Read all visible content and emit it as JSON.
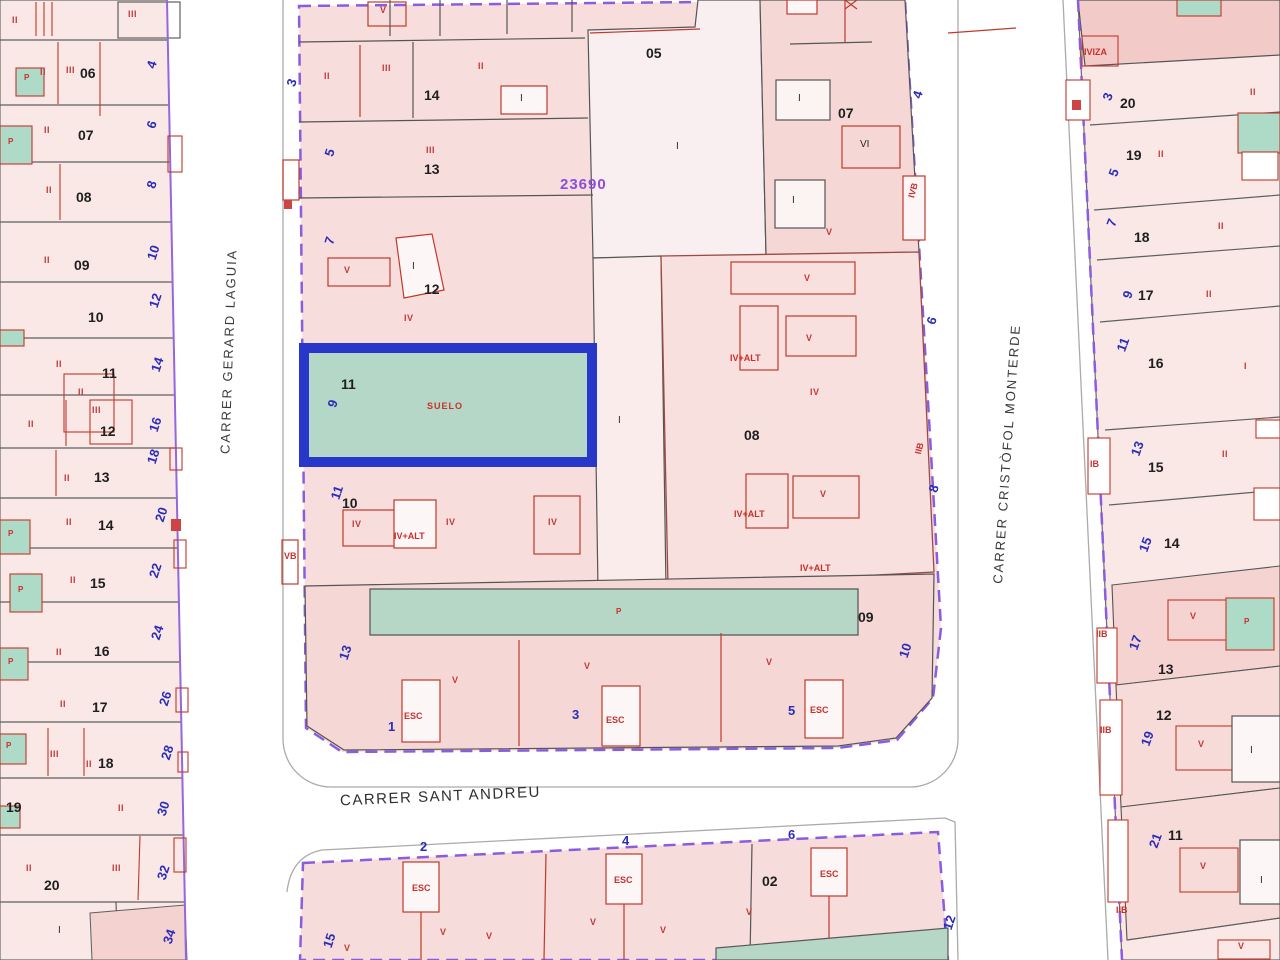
{
  "map": {
    "reference_number": "23690",
    "streets": {
      "left": "CARRER GERARD LAGUIA",
      "right": "CARRER CRISTÒFOL MONTERDE",
      "bottom": "CARRER SANT ANDREU"
    },
    "selected_parcel": {
      "number": "11",
      "street_number": "9",
      "land_label": "SUELO",
      "fill": "#b5d7c8",
      "outline": "#2637c9"
    },
    "colors": {
      "parcel_pink": "#f9e8e6",
      "parcel_pink_dark": "#f2cbc9",
      "teal_green": "#b5d7c8",
      "selection_blue": "#2637c9",
      "boundary_purple": "#8a5ce0",
      "street_number_blue": "#2c2cb8",
      "label_red": "#c9302c",
      "reference_purple": "#8a4fd8"
    },
    "labels": [
      {
        "t": "06",
        "x": 80,
        "y": 66,
        "c": "pn"
      },
      {
        "t": "07",
        "x": 78,
        "y": 128,
        "c": "pn"
      },
      {
        "t": "08",
        "x": 76,
        "y": 190,
        "c": "pn"
      },
      {
        "t": "09",
        "x": 74,
        "y": 258,
        "c": "pn"
      },
      {
        "t": "10",
        "x": 88,
        "y": 310,
        "c": "pn"
      },
      {
        "t": "11",
        "x": 102,
        "y": 366,
        "c": "pn"
      },
      {
        "t": "12",
        "x": 100,
        "y": 424,
        "c": "pn"
      },
      {
        "t": "13",
        "x": 94,
        "y": 470,
        "c": "pn"
      },
      {
        "t": "14",
        "x": 98,
        "y": 518,
        "c": "pn"
      },
      {
        "t": "15",
        "x": 90,
        "y": 576,
        "c": "pn"
      },
      {
        "t": "16",
        "x": 94,
        "y": 644,
        "c": "pn"
      },
      {
        "t": "17",
        "x": 92,
        "y": 700,
        "c": "pn"
      },
      {
        "t": "18",
        "x": 98,
        "y": 756,
        "c": "pn"
      },
      {
        "t": "19",
        "x": 6,
        "y": 800,
        "c": "pn"
      },
      {
        "t": "20",
        "x": 44,
        "y": 878,
        "c": "pn"
      },
      {
        "t": "4",
        "x": 148,
        "y": 58,
        "c": "sn",
        "r": -72
      },
      {
        "t": "6",
        "x": 148,
        "y": 118,
        "c": "sn",
        "r": -72
      },
      {
        "t": "8",
        "x": 148,
        "y": 178,
        "c": "sn",
        "r": -72
      },
      {
        "t": "10",
        "x": 146,
        "y": 246,
        "c": "sn",
        "r": -72
      },
      {
        "t": "12",
        "x": 148,
        "y": 294,
        "c": "sn",
        "r": -72
      },
      {
        "t": "14",
        "x": 150,
        "y": 358,
        "c": "sn",
        "r": -72
      },
      {
        "t": "16",
        "x": 148,
        "y": 418,
        "c": "sn",
        "r": -72
      },
      {
        "t": "18",
        "x": 146,
        "y": 450,
        "c": "sn",
        "r": -72
      },
      {
        "t": "20",
        "x": 154,
        "y": 508,
        "c": "sn",
        "r": -72
      },
      {
        "t": "22",
        "x": 148,
        "y": 564,
        "c": "sn",
        "r": -72
      },
      {
        "t": "24",
        "x": 150,
        "y": 626,
        "c": "sn",
        "r": -72
      },
      {
        "t": "26",
        "x": 158,
        "y": 692,
        "c": "sn",
        "r": -72
      },
      {
        "t": "28",
        "x": 160,
        "y": 746,
        "c": "sn",
        "r": -72
      },
      {
        "t": "30",
        "x": 156,
        "y": 802,
        "c": "sn",
        "r": -72
      },
      {
        "t": "32",
        "x": 156,
        "y": 866,
        "c": "sn",
        "r": -72
      },
      {
        "t": "34",
        "x": 162,
        "y": 930,
        "c": "sn",
        "r": -72
      },
      {
        "t": "II",
        "x": 12,
        "y": 16,
        "c": "rm"
      },
      {
        "t": "III",
        "x": 128,
        "y": 10,
        "c": "rm"
      },
      {
        "t": "II",
        "x": 40,
        "y": 68,
        "c": "rm"
      },
      {
        "t": "III",
        "x": 66,
        "y": 66,
        "c": "rm"
      },
      {
        "t": "II",
        "x": 44,
        "y": 126,
        "c": "rm"
      },
      {
        "t": "II",
        "x": 46,
        "y": 186,
        "c": "rm"
      },
      {
        "t": "II",
        "x": 44,
        "y": 256,
        "c": "rm"
      },
      {
        "t": "II",
        "x": 56,
        "y": 360,
        "c": "rm"
      },
      {
        "t": "II",
        "x": 78,
        "y": 388,
        "c": "rm"
      },
      {
        "t": "III",
        "x": 92,
        "y": 406,
        "c": "rm"
      },
      {
        "t": "II",
        "x": 28,
        "y": 420,
        "c": "rm"
      },
      {
        "t": "II",
        "x": 64,
        "y": 474,
        "c": "rm"
      },
      {
        "t": "II",
        "x": 66,
        "y": 518,
        "c": "rm"
      },
      {
        "t": "II",
        "x": 70,
        "y": 576,
        "c": "rm"
      },
      {
        "t": "II",
        "x": 56,
        "y": 648,
        "c": "rm"
      },
      {
        "t": "II",
        "x": 60,
        "y": 700,
        "c": "rm"
      },
      {
        "t": "III",
        "x": 50,
        "y": 750,
        "c": "rm"
      },
      {
        "t": "II",
        "x": 86,
        "y": 760,
        "c": "rm"
      },
      {
        "t": "II",
        "x": 118,
        "y": 804,
        "c": "rm"
      },
      {
        "t": "II",
        "x": 26,
        "y": 864,
        "c": "rm"
      },
      {
        "t": "III",
        "x": 112,
        "y": 864,
        "c": "rm"
      },
      {
        "t": "P",
        "x": 24,
        "y": 74,
        "c": "rp"
      },
      {
        "t": "P",
        "x": 8,
        "y": 138,
        "c": "rp"
      },
      {
        "t": "P",
        "x": 8,
        "y": 530,
        "c": "rp"
      },
      {
        "t": "P",
        "x": 18,
        "y": 586,
        "c": "rp"
      },
      {
        "t": "P",
        "x": 8,
        "y": 658,
        "c": "rp"
      },
      {
        "t": "P",
        "x": 6,
        "y": 742,
        "c": "rp"
      },
      {
        "t": "I",
        "x": 58,
        "y": 926,
        "c": "bk"
      },
      {
        "t": "V",
        "x": 380,
        "y": 6,
        "c": "rm"
      },
      {
        "t": "II",
        "x": 324,
        "y": 72,
        "c": "rm"
      },
      {
        "t": "III",
        "x": 382,
        "y": 64,
        "c": "rm"
      },
      {
        "t": "14",
        "x": 424,
        "y": 88,
        "c": "pn"
      },
      {
        "t": "II",
        "x": 478,
        "y": 62,
        "c": "rm"
      },
      {
        "t": "I",
        "x": 520,
        "y": 94,
        "c": "bk"
      },
      {
        "t": "3",
        "x": 288,
        "y": 76,
        "c": "sn",
        "r": -72
      },
      {
        "t": "5",
        "x": 326,
        "y": 146,
        "c": "sn",
        "r": -72
      },
      {
        "t": "III",
        "x": 426,
        "y": 146,
        "c": "rm"
      },
      {
        "t": "13",
        "x": 424,
        "y": 162,
        "c": "pn"
      },
      {
        "t": "05",
        "x": 646,
        "y": 46,
        "c": "pn"
      },
      {
        "t": "I",
        "x": 676,
        "y": 142,
        "c": "bk"
      },
      {
        "t": "07",
        "x": 838,
        "y": 106,
        "c": "pn"
      },
      {
        "t": "I",
        "x": 798,
        "y": 94,
        "c": "bk"
      },
      {
        "t": "VI",
        "x": 860,
        "y": 140,
        "c": "bk"
      },
      {
        "t": "I",
        "x": 792,
        "y": 196,
        "c": "bk"
      },
      {
        "t": "V",
        "x": 826,
        "y": 228,
        "c": "rm"
      },
      {
        "t": "IVB",
        "x": 906,
        "y": 186,
        "c": "rl",
        "r": -75
      },
      {
        "t": "4",
        "x": 914,
        "y": 88,
        "c": "sn",
        "r": -72
      },
      {
        "t": "7",
        "x": 326,
        "y": 234,
        "c": "sn",
        "r": -72
      },
      {
        "t": "V",
        "x": 344,
        "y": 266,
        "c": "rm"
      },
      {
        "t": "I",
        "x": 412,
        "y": 262,
        "c": "bk"
      },
      {
        "t": "12",
        "x": 424,
        "y": 282,
        "c": "pn"
      },
      {
        "t": "IV",
        "x": 404,
        "y": 314,
        "c": "rm"
      },
      {
        "t": "I",
        "x": 618,
        "y": 416,
        "c": "bk"
      },
      {
        "t": "V",
        "x": 804,
        "y": 274,
        "c": "rm"
      },
      {
        "t": "V",
        "x": 806,
        "y": 334,
        "c": "rm"
      },
      {
        "t": "IV+ALT",
        "x": 730,
        "y": 354,
        "c": "rl"
      },
      {
        "t": "IV",
        "x": 810,
        "y": 388,
        "c": "rm"
      },
      {
        "t": "08",
        "x": 744,
        "y": 428,
        "c": "pn"
      },
      {
        "t": "V",
        "x": 820,
        "y": 490,
        "c": "rm"
      },
      {
        "t": "IV+ALT",
        "x": 734,
        "y": 510,
        "c": "rl"
      },
      {
        "t": "IV+ALT",
        "x": 800,
        "y": 564,
        "c": "rl"
      },
      {
        "t": "6",
        "x": 928,
        "y": 314,
        "c": "sn",
        "r": -72
      },
      {
        "t": "IIB",
        "x": 914,
        "y": 444,
        "c": "rl",
        "r": -75
      },
      {
        "t": "8",
        "x": 930,
        "y": 482,
        "c": "sn",
        "r": -72
      },
      {
        "t": "11",
        "x": 330,
        "y": 486,
        "c": "sn",
        "r": -72
      },
      {
        "t": "10",
        "x": 342,
        "y": 496,
        "c": "pn"
      },
      {
        "t": "IV",
        "x": 352,
        "y": 520,
        "c": "rm"
      },
      {
        "t": "IV+ALT",
        "x": 394,
        "y": 532,
        "c": "rl"
      },
      {
        "t": "IV",
        "x": 446,
        "y": 518,
        "c": "rm"
      },
      {
        "t": "IV",
        "x": 548,
        "y": 518,
        "c": "rm"
      },
      {
        "t": "VB",
        "x": 284,
        "y": 552,
        "c": "rl"
      },
      {
        "t": "P",
        "x": 616,
        "y": 608,
        "c": "rp"
      },
      {
        "t": "09",
        "x": 858,
        "y": 610,
        "c": "pn"
      },
      {
        "t": "13",
        "x": 338,
        "y": 646,
        "c": "sn",
        "r": -72
      },
      {
        "t": "V",
        "x": 452,
        "y": 676,
        "c": "rm"
      },
      {
        "t": "V",
        "x": 584,
        "y": 662,
        "c": "rm"
      },
      {
        "t": "V",
        "x": 766,
        "y": 658,
        "c": "rm"
      },
      {
        "t": "ESC",
        "x": 404,
        "y": 712,
        "c": "rl"
      },
      {
        "t": "1",
        "x": 388,
        "y": 720,
        "c": "sn"
      },
      {
        "t": "ESC",
        "x": 606,
        "y": 716,
        "c": "rl"
      },
      {
        "t": "3",
        "x": 572,
        "y": 708,
        "c": "sn"
      },
      {
        "t": "ESC",
        "x": 810,
        "y": 706,
        "c": "rl"
      },
      {
        "t": "5",
        "x": 788,
        "y": 704,
        "c": "sn"
      },
      {
        "t": "10",
        "x": 898,
        "y": 644,
        "c": "sn",
        "r": -72
      },
      {
        "t": "IVIZA",
        "x": 1084,
        "y": 48,
        "c": "rl"
      },
      {
        "t": "3",
        "x": 1104,
        "y": 90,
        "c": "sn",
        "r": -70
      },
      {
        "t": "20",
        "x": 1120,
        "y": 96,
        "c": "pn"
      },
      {
        "t": "II",
        "x": 1250,
        "y": 88,
        "c": "rm"
      },
      {
        "t": "19",
        "x": 1126,
        "y": 148,
        "c": "pn"
      },
      {
        "t": "II",
        "x": 1158,
        "y": 150,
        "c": "rm"
      },
      {
        "t": "5",
        "x": 1110,
        "y": 166,
        "c": "sn",
        "r": -70
      },
      {
        "t": "7",
        "x": 1108,
        "y": 216,
        "c": "sn",
        "r": -70
      },
      {
        "t": "18",
        "x": 1134,
        "y": 230,
        "c": "pn"
      },
      {
        "t": "II",
        "x": 1218,
        "y": 222,
        "c": "rm"
      },
      {
        "t": "9",
        "x": 1124,
        "y": 288,
        "c": "sn",
        "r": -70
      },
      {
        "t": "17",
        "x": 1138,
        "y": 288,
        "c": "pn"
      },
      {
        "t": "II",
        "x": 1206,
        "y": 290,
        "c": "rm"
      },
      {
        "t": "11",
        "x": 1116,
        "y": 338,
        "c": "sn",
        "r": -70
      },
      {
        "t": "16",
        "x": 1148,
        "y": 356,
        "c": "pn"
      },
      {
        "t": "I",
        "x": 1244,
        "y": 362,
        "c": "rm"
      },
      {
        "t": "13",
        "x": 1130,
        "y": 442,
        "c": "sn",
        "r": -70
      },
      {
        "t": "15",
        "x": 1148,
        "y": 460,
        "c": "pn"
      },
      {
        "t": "II",
        "x": 1222,
        "y": 450,
        "c": "rm"
      },
      {
        "t": "IB",
        "x": 1090,
        "y": 460,
        "c": "rl"
      },
      {
        "t": "15",
        "x": 1138,
        "y": 538,
        "c": "sn",
        "r": -70
      },
      {
        "t": "14",
        "x": 1164,
        "y": 536,
        "c": "pn"
      },
      {
        "t": "IIB",
        "x": 1096,
        "y": 630,
        "c": "rl"
      },
      {
        "t": "17",
        "x": 1128,
        "y": 636,
        "c": "sn",
        "r": -70
      },
      {
        "t": "V",
        "x": 1190,
        "y": 612,
        "c": "rm"
      },
      {
        "t": "P",
        "x": 1244,
        "y": 618,
        "c": "rp"
      },
      {
        "t": "13",
        "x": 1158,
        "y": 662,
        "c": "pn"
      },
      {
        "t": "12",
        "x": 1156,
        "y": 708,
        "c": "pn"
      },
      {
        "t": "IIB",
        "x": 1100,
        "y": 726,
        "c": "rl"
      },
      {
        "t": "19",
        "x": 1140,
        "y": 732,
        "c": "sn",
        "r": -70
      },
      {
        "t": "V",
        "x": 1198,
        "y": 740,
        "c": "rm"
      },
      {
        "t": "I",
        "x": 1250,
        "y": 746,
        "c": "bk"
      },
      {
        "t": "11",
        "x": 1168,
        "y": 828,
        "c": "pn"
      },
      {
        "t": "21",
        "x": 1148,
        "y": 834,
        "c": "sn",
        "r": -70
      },
      {
        "t": "V",
        "x": 1200,
        "y": 862,
        "c": "rm"
      },
      {
        "t": "I",
        "x": 1260,
        "y": 876,
        "c": "bk"
      },
      {
        "t": "IIB",
        "x": 1116,
        "y": 906,
        "c": "rl"
      },
      {
        "t": "V",
        "x": 1238,
        "y": 942,
        "c": "rm"
      },
      {
        "t": "2",
        "x": 420,
        "y": 840,
        "c": "sn"
      },
      {
        "t": "4",
        "x": 622,
        "y": 834,
        "c": "sn"
      },
      {
        "t": "6",
        "x": 788,
        "y": 828,
        "c": "sn"
      },
      {
        "t": "15",
        "x": 322,
        "y": 934,
        "c": "sn",
        "r": -72
      },
      {
        "t": "12",
        "x": 942,
        "y": 916,
        "c": "sn",
        "r": -72
      },
      {
        "t": "02",
        "x": 762,
        "y": 874,
        "c": "pn"
      },
      {
        "t": "ESC",
        "x": 412,
        "y": 884,
        "c": "rl"
      },
      {
        "t": "ESC",
        "x": 614,
        "y": 876,
        "c": "rl"
      },
      {
        "t": "ESC",
        "x": 820,
        "y": 870,
        "c": "rl"
      },
      {
        "t": "V",
        "x": 344,
        "y": 944,
        "c": "rm"
      },
      {
        "t": "V",
        "x": 440,
        "y": 928,
        "c": "rm"
      },
      {
        "t": "V",
        "x": 486,
        "y": 932,
        "c": "rm"
      },
      {
        "t": "V",
        "x": 590,
        "y": 918,
        "c": "rm"
      },
      {
        "t": "V",
        "x": 660,
        "y": 926,
        "c": "rm"
      },
      {
        "t": "V",
        "x": 746,
        "y": 908,
        "c": "rm"
      }
    ]
  }
}
